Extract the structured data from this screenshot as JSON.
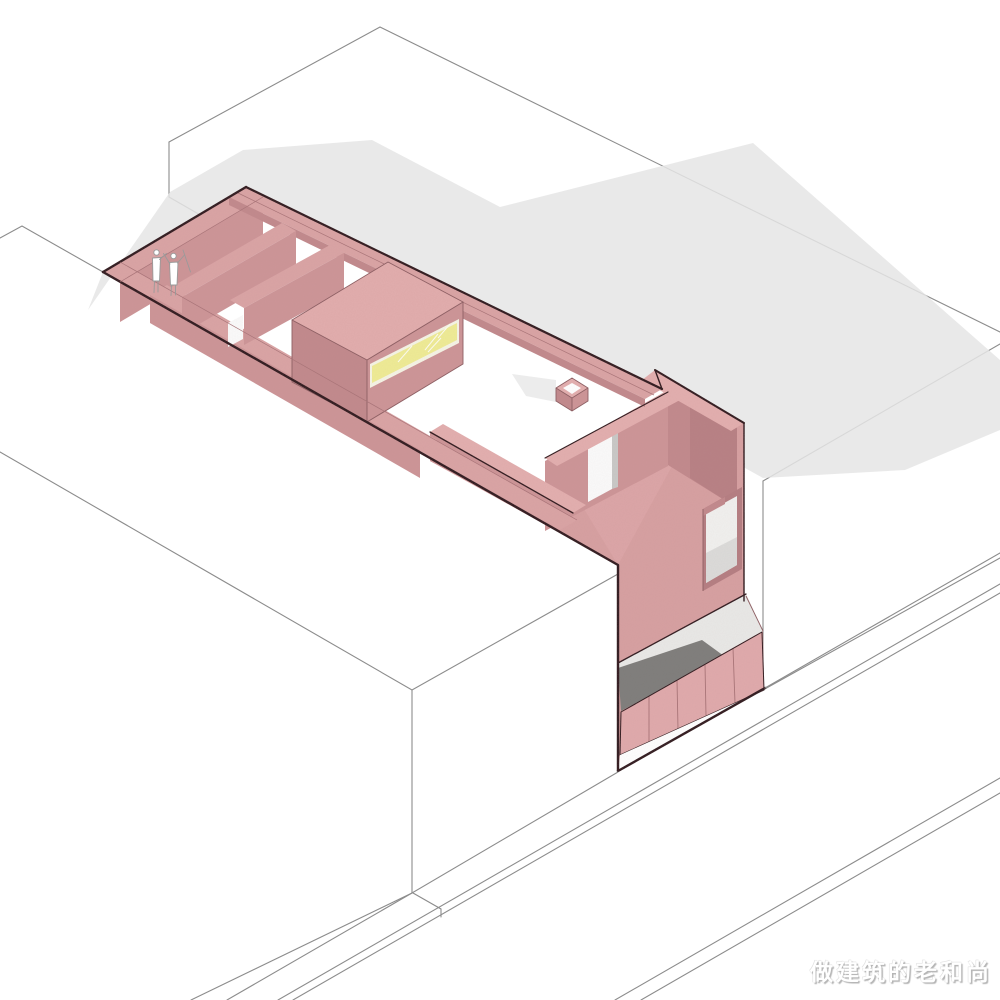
{
  "watermark": {
    "text": "做建筑的老和尚"
  },
  "figures": {
    "count": 2
  },
  "colors": {
    "background": "#ffffff",
    "line_thin": "#8c8c8c",
    "line_dark": "#2a171a",
    "pink_band": "#daa4a5",
    "pink_band_light": "#e3afaf",
    "pink_top": "#e2adad",
    "pink_face": "#d7a0a2",
    "pink_face_med": "#cd9598",
    "pink_face_dark": "#c28a8d",
    "pink_face_deep": "#b57e82",
    "panel_pink": "#e0aaac",
    "yellow_window": "#efec96",
    "pane_white": "#f1f1ef",
    "shadow_gray": "#e5e5e5",
    "entry_gray": "#7e7e7c",
    "figure_line": "#9a9a9a",
    "watermark": "#ffffff"
  }
}
